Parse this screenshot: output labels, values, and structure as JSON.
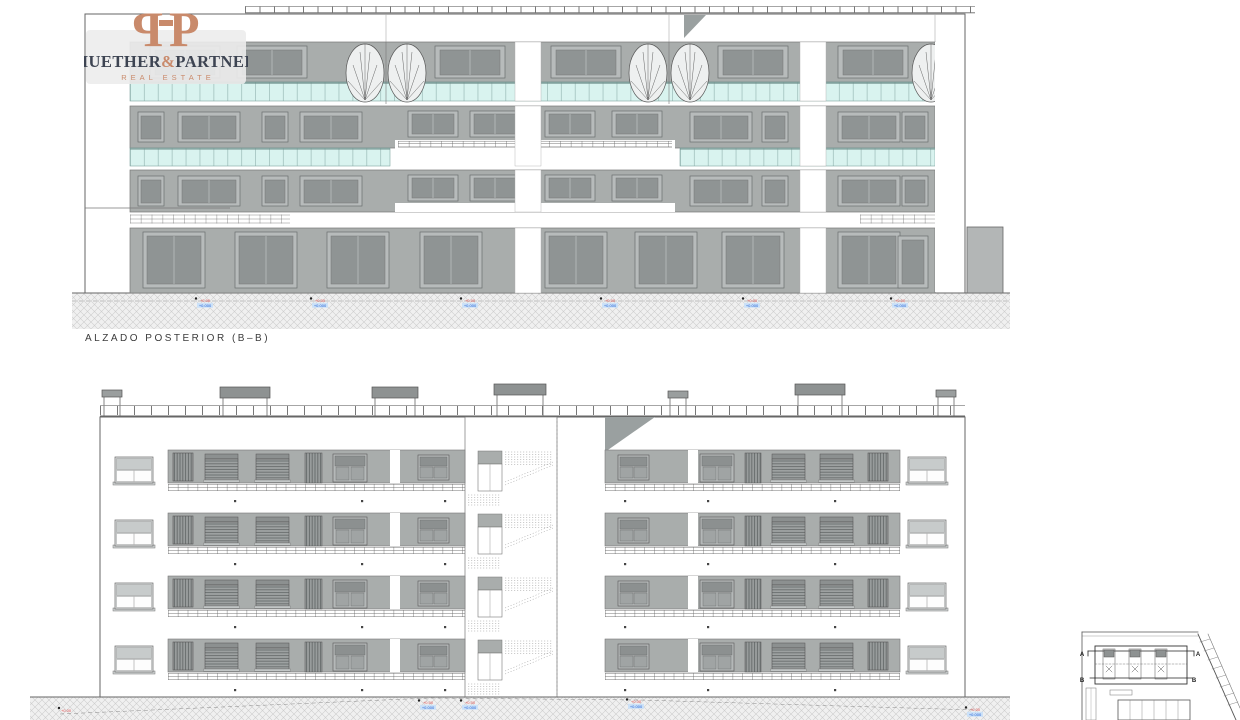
{
  "brand": {
    "monogram_left": "P",
    "monogram_right": "P",
    "name_first": "HUETHER",
    "name_amp": "&",
    "name_second": "PARTNER",
    "tagline": "REAL ESTATE"
  },
  "titles": {
    "rear_elevation": "ALZADO POSTERIOR (B–B)"
  },
  "site_plan": {
    "section_a": "A",
    "section_b": "B"
  },
  "levels": {
    "top": [
      {
        "red": "+0.00",
        "blue": "+0.000"
      },
      {
        "red": "+0.00",
        "blue": "+0.000"
      },
      {
        "red": "+0.00",
        "blue": "+0.000"
      },
      {
        "red": "+0.00",
        "blue": "+0.000"
      },
      {
        "red": "+0.00",
        "blue": "+0.000"
      },
      {
        "red": "+0.00",
        "blue": "+0.000"
      }
    ],
    "bottom": [
      {
        "red": "+0.00",
        "blue": "+0.000"
      },
      {
        "red": "+0.00",
        "blue": "+0.000"
      },
      {
        "red": "+0.00",
        "blue": "+0.000"
      },
      {
        "red": "+0.00",
        "blue": "+0.000"
      }
    ],
    "ground_ref": {
      "red": "+0.00"
    }
  },
  "colors": {
    "accent": "#c98a6b",
    "ink": "#3d4452",
    "glass": "#d9f3ef",
    "red_marker": "#e05050",
    "blue_marker": "#1f5fd6"
  }
}
